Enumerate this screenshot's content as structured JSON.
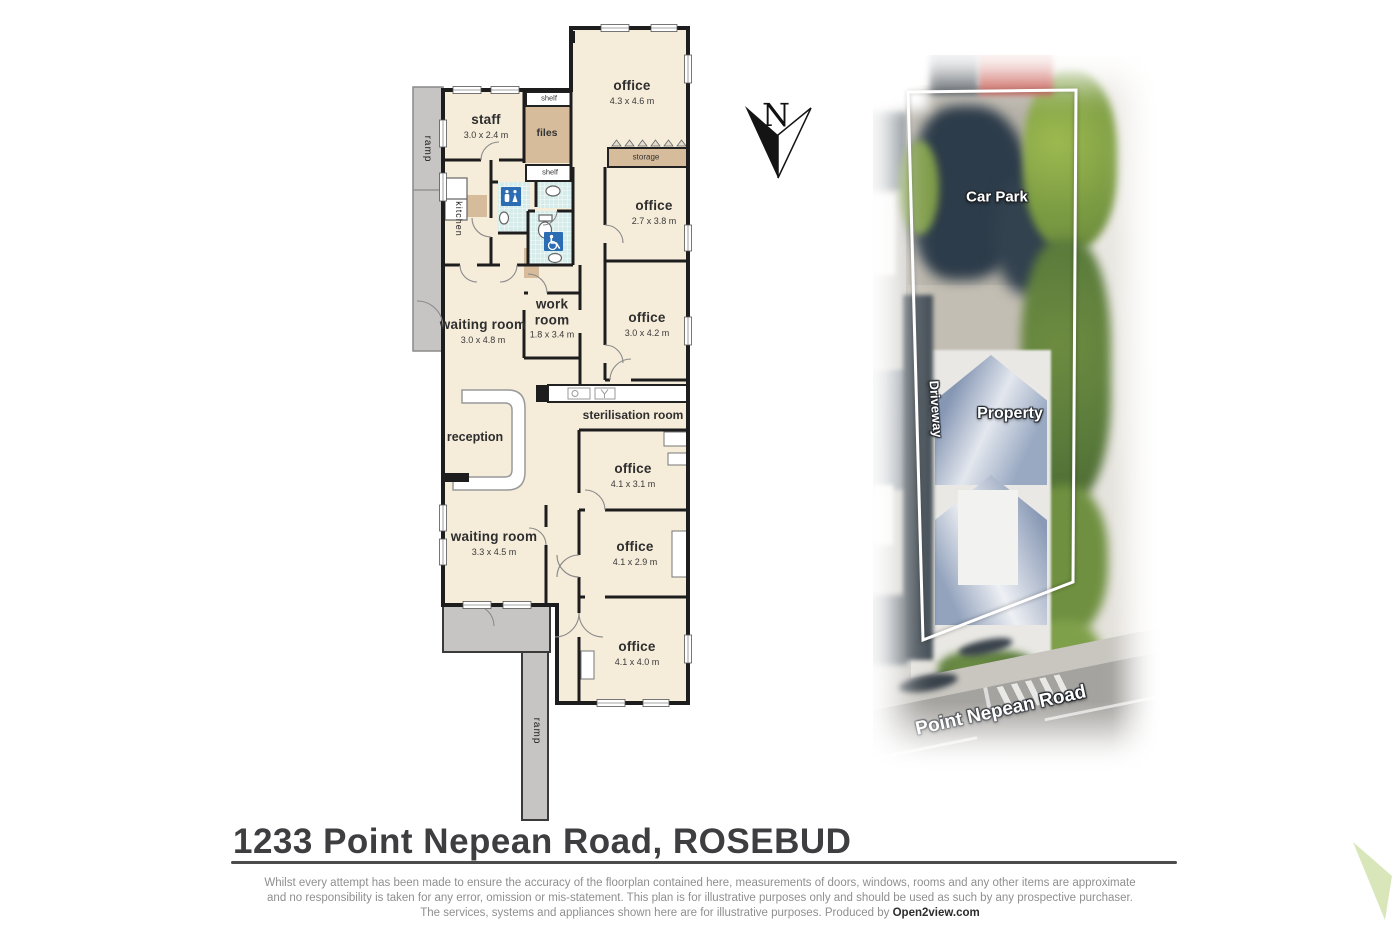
{
  "address_title": "1233 Point Nepean Road, ROSEBUD",
  "compass": {
    "n": "N"
  },
  "plan": {
    "rooms": [
      {
        "name": "office",
        "dims": "4.3 x 4.6 m"
      },
      {
        "name": "staff",
        "dims": "3.0 x 2.4 m"
      },
      {
        "name": "office",
        "dims": "2.7 x 3.8 m"
      },
      {
        "name": "waiting room",
        "dims": "3.0 x 4.8 m"
      },
      {
        "name": "work room",
        "dims": "1.8 x 3.4 m"
      },
      {
        "name": "office",
        "dims": "3.0 x 4.2 m"
      },
      {
        "name": "office",
        "dims": "4.1 x 3.1 m"
      },
      {
        "name": "waiting room",
        "dims": "3.3 x 4.5 m"
      },
      {
        "name": "office",
        "dims": "4.1 x 2.9 m"
      },
      {
        "name": "office",
        "dims": "4.1 x 4.0 m"
      }
    ],
    "areas": {
      "shelf_top": "shelf",
      "files": "files",
      "shelf_bottom": "shelf",
      "storage": "storage",
      "kitchen": "kitchen",
      "ramp_left": "ramp",
      "ramp_bottom": "ramp",
      "sterilisation": "sterilisation room",
      "reception": "reception"
    }
  },
  "aerial": {
    "labels": {
      "car_park": "Car Park",
      "driveway": "Driveway",
      "property": "Property",
      "road": "Point Nepean Road"
    }
  },
  "footer": {
    "line1": "Whilst every attempt has been made to ensure the accuracy of the floorplan contained here, measurements of doors, windows, rooms and any other items are approximate",
    "line2": "and no responsibility is taken for any error, omission or mis-statement.  This plan is for illustrative purposes only and should be used as such by any prospective purchaser.",
    "line3_prefix": "The services, systems and appliances shown here are for illustrative purposes.   Produced by ",
    "brand": "Open2view.com"
  },
  "colors": {
    "floor": "#f5ecda",
    "wall": "#1d1d1d",
    "cabinet_tan": "#d7bc9b",
    "ramp_grey": "#c7c5c3",
    "tile_blue": "#d6ecea",
    "icon_blue": "#2b6cb3",
    "corner_triangle_green": "#d8e6ba"
  }
}
